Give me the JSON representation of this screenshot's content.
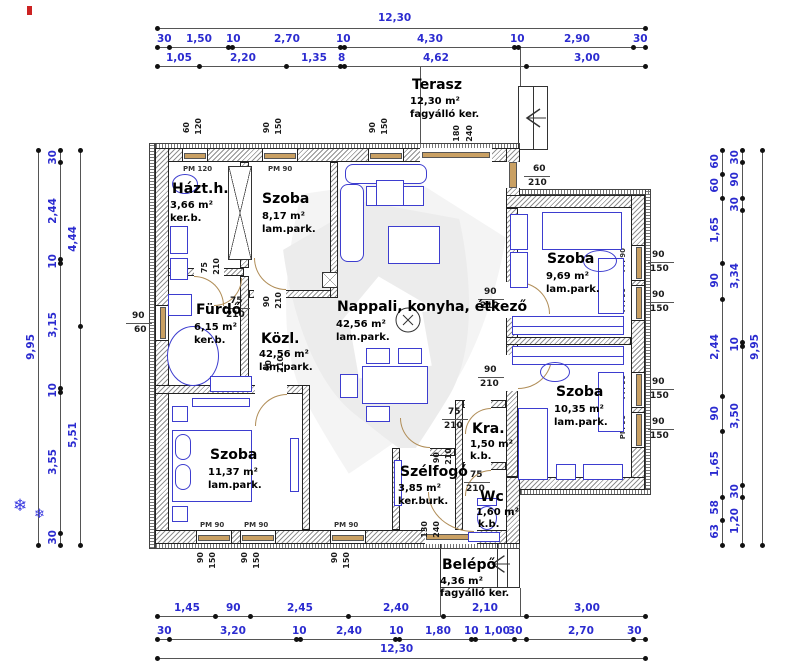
{
  "rooms": {
    "terasz": {
      "name": "Terasz",
      "area": "12,30 m²",
      "floor": "fagyálló ker."
    },
    "hazth": {
      "name": "Házt.h.",
      "area": "3,66 m²",
      "floor": "ker.b."
    },
    "szoba_nw": {
      "name": "Szoba",
      "area": "8,17 m²",
      "floor": "lam.park."
    },
    "nappali": {
      "name": "Nappali, konyha, étkező",
      "area": "42,56 m²",
      "floor": "lam.park."
    },
    "furdo": {
      "name": "Fürdő",
      "area": "6,15 m²",
      "floor": "ker.b."
    },
    "kozl": {
      "name": "Közl.",
      "area": "42,56 m²",
      "floor": "lam.park."
    },
    "szoba_ne": {
      "name": "Szoba",
      "area": "9,69 m²",
      "floor": "lam.park."
    },
    "szoba_se": {
      "name": "Szoba",
      "area": "10,35 m²",
      "floor": "lam.park."
    },
    "szoba_sw": {
      "name": "Szoba",
      "area": "11,37 m²",
      "floor": "lam.park."
    },
    "kamra": {
      "name": "Kra.",
      "area": "1,50 m²",
      "floor": "k.b."
    },
    "szelfogo": {
      "name": "Szélfogó",
      "area": "3,85 m²",
      "floor": "ker.burk."
    },
    "wc": {
      "name": "Wc",
      "area": "1,60 m²",
      "floor": "k.b."
    },
    "belepo": {
      "name": "Belépő",
      "area": "4,36 m²",
      "floor": "fagyálló ker."
    }
  },
  "dims": {
    "top": {
      "total": "12,30",
      "row2": [
        "30",
        "1,50",
        "10",
        "2,70",
        "10",
        "4,30",
        "10",
        "2,90",
        "30"
      ],
      "row3": [
        "1,05",
        "2,20",
        "1,35",
        "8",
        "4,62",
        "3,00"
      ]
    },
    "bottom": {
      "row1": [
        "1,45",
        "90",
        "2,45",
        "2,40",
        "2,10",
        "3,00"
      ],
      "row2": [
        "30",
        "3,20",
        "10",
        "2,40",
        "10",
        "1,80",
        "10",
        "1,00",
        "30",
        "2,70",
        "30"
      ],
      "total": "12,30"
    },
    "left": {
      "total": "9,95",
      "mid": [
        "30",
        "2,44",
        "10",
        "3,15",
        "10",
        "3,55",
        "30"
      ],
      "inner": [
        "4,44",
        "5,51"
      ]
    },
    "right": {
      "col1": [
        "60",
        "60",
        "1,65",
        "90",
        "2,44",
        "90",
        "1,65",
        "58",
        "63"
      ],
      "col2": [
        "30",
        "90",
        "30",
        "3,34",
        "10",
        "3,50",
        "30",
        "1,20"
      ],
      "total": "9,95"
    }
  },
  "openings": {
    "pm120": "PM 120",
    "pm90": "PM 90",
    "s60": "60",
    "s120": "120",
    "s90": "90",
    "s150": "150",
    "s180": "180",
    "s240": "240",
    "s210": "210",
    "s75": "75",
    "s130": "130"
  },
  "symbols": {
    "snowflake": "❄"
  },
  "colors": {
    "dim_text": "#2b2bd0",
    "furniture": "#3d3dcf",
    "wood": "#c9a063",
    "watermark": "#ececec"
  }
}
